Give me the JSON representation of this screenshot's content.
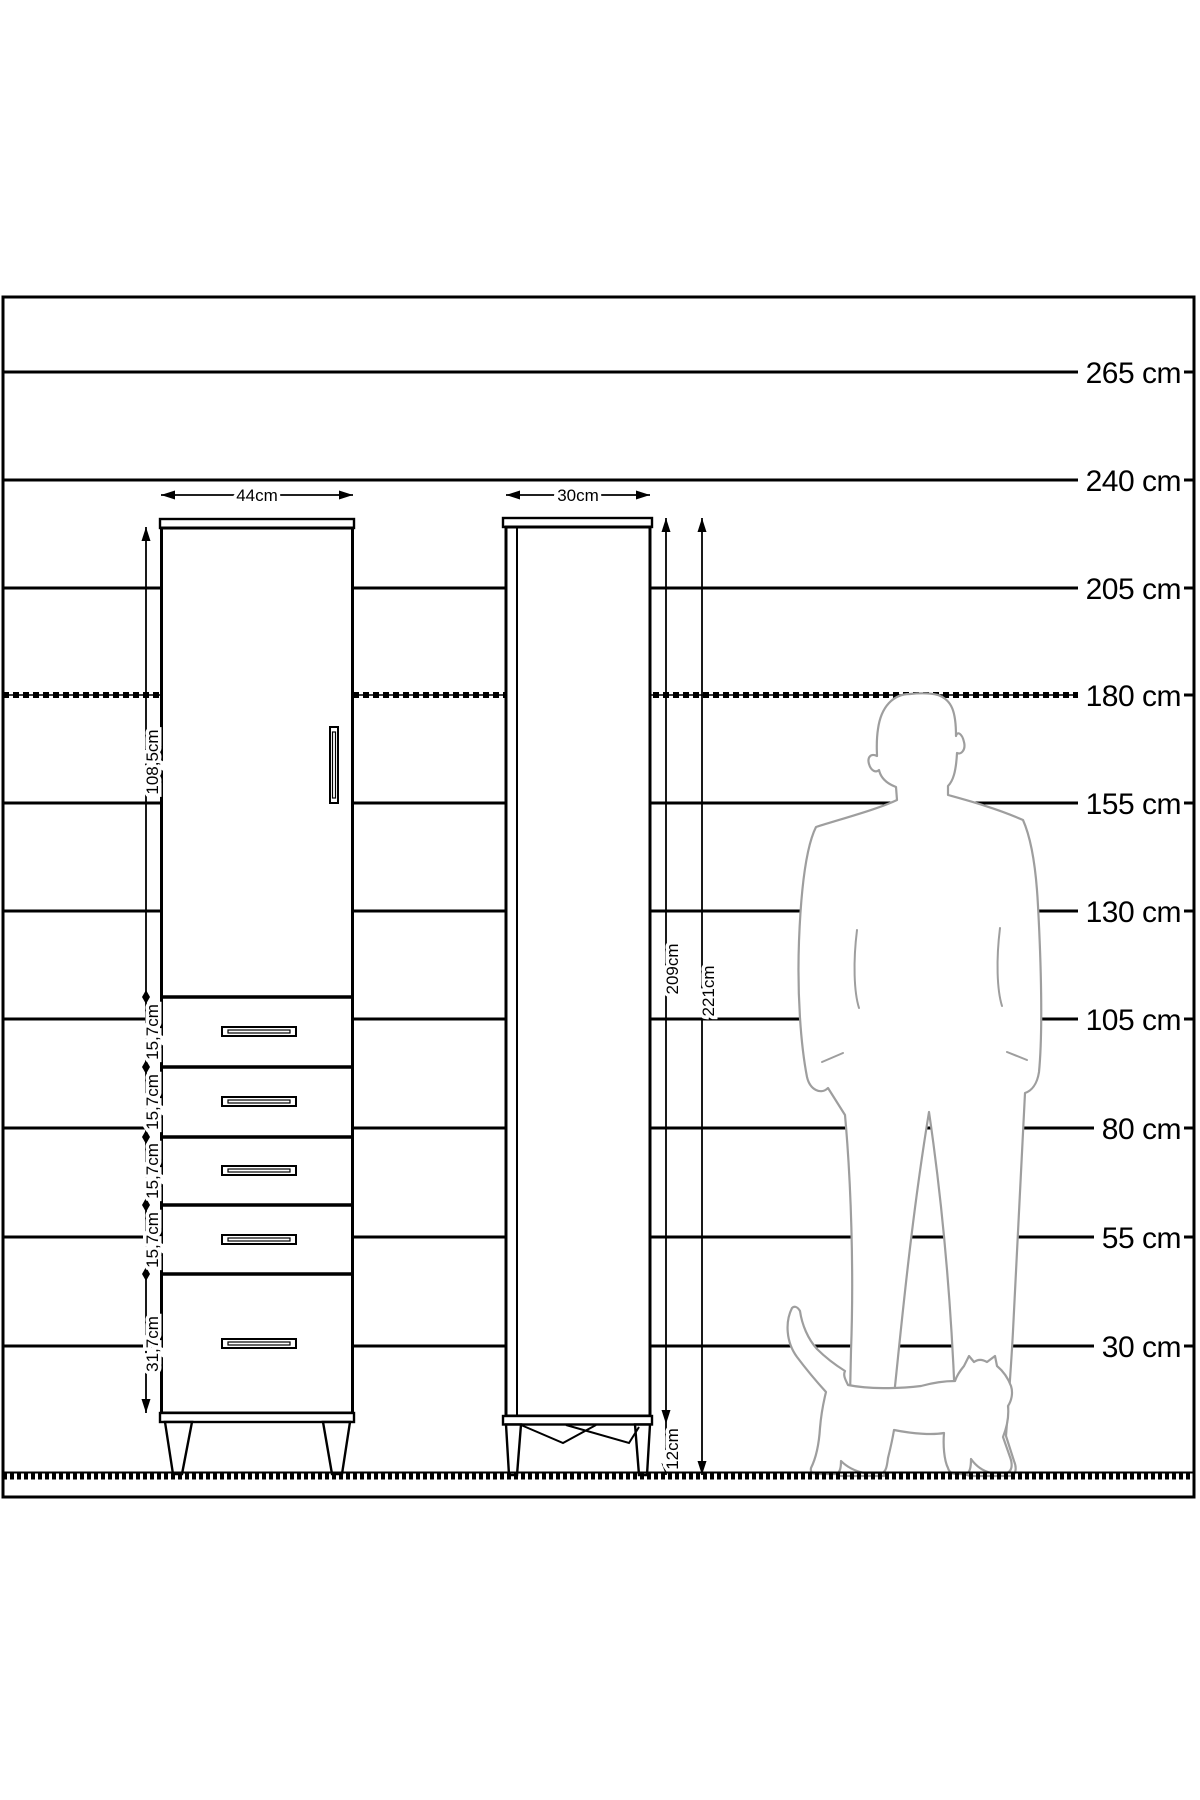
{
  "colors": {
    "line": "#000000",
    "silhouette_outline": "#9e9e9e",
    "background": "#ffffff"
  },
  "ruler": {
    "labels": [
      "265 cm",
      "240 cm",
      "205 cm",
      "180 cm",
      "155 cm",
      "130 cm",
      "105 cm",
      "80 cm",
      "55 cm",
      "30 cm"
    ]
  },
  "front_view": {
    "width_label": "44cm",
    "door_height_label": "108,5cm",
    "drawer_height_labels": [
      "15,7cm",
      "15,7cm",
      "15,7cm",
      "15,7cm"
    ],
    "bottom_drawer_height_label": "31,7cm"
  },
  "side_view": {
    "depth_label": "30cm",
    "body_height_label": "209cm",
    "total_height_label": "221cm",
    "leg_height_label": "12cm"
  },
  "figures": {
    "man_icon": "man-silhouette",
    "cat_icon": "cat-silhouette"
  }
}
